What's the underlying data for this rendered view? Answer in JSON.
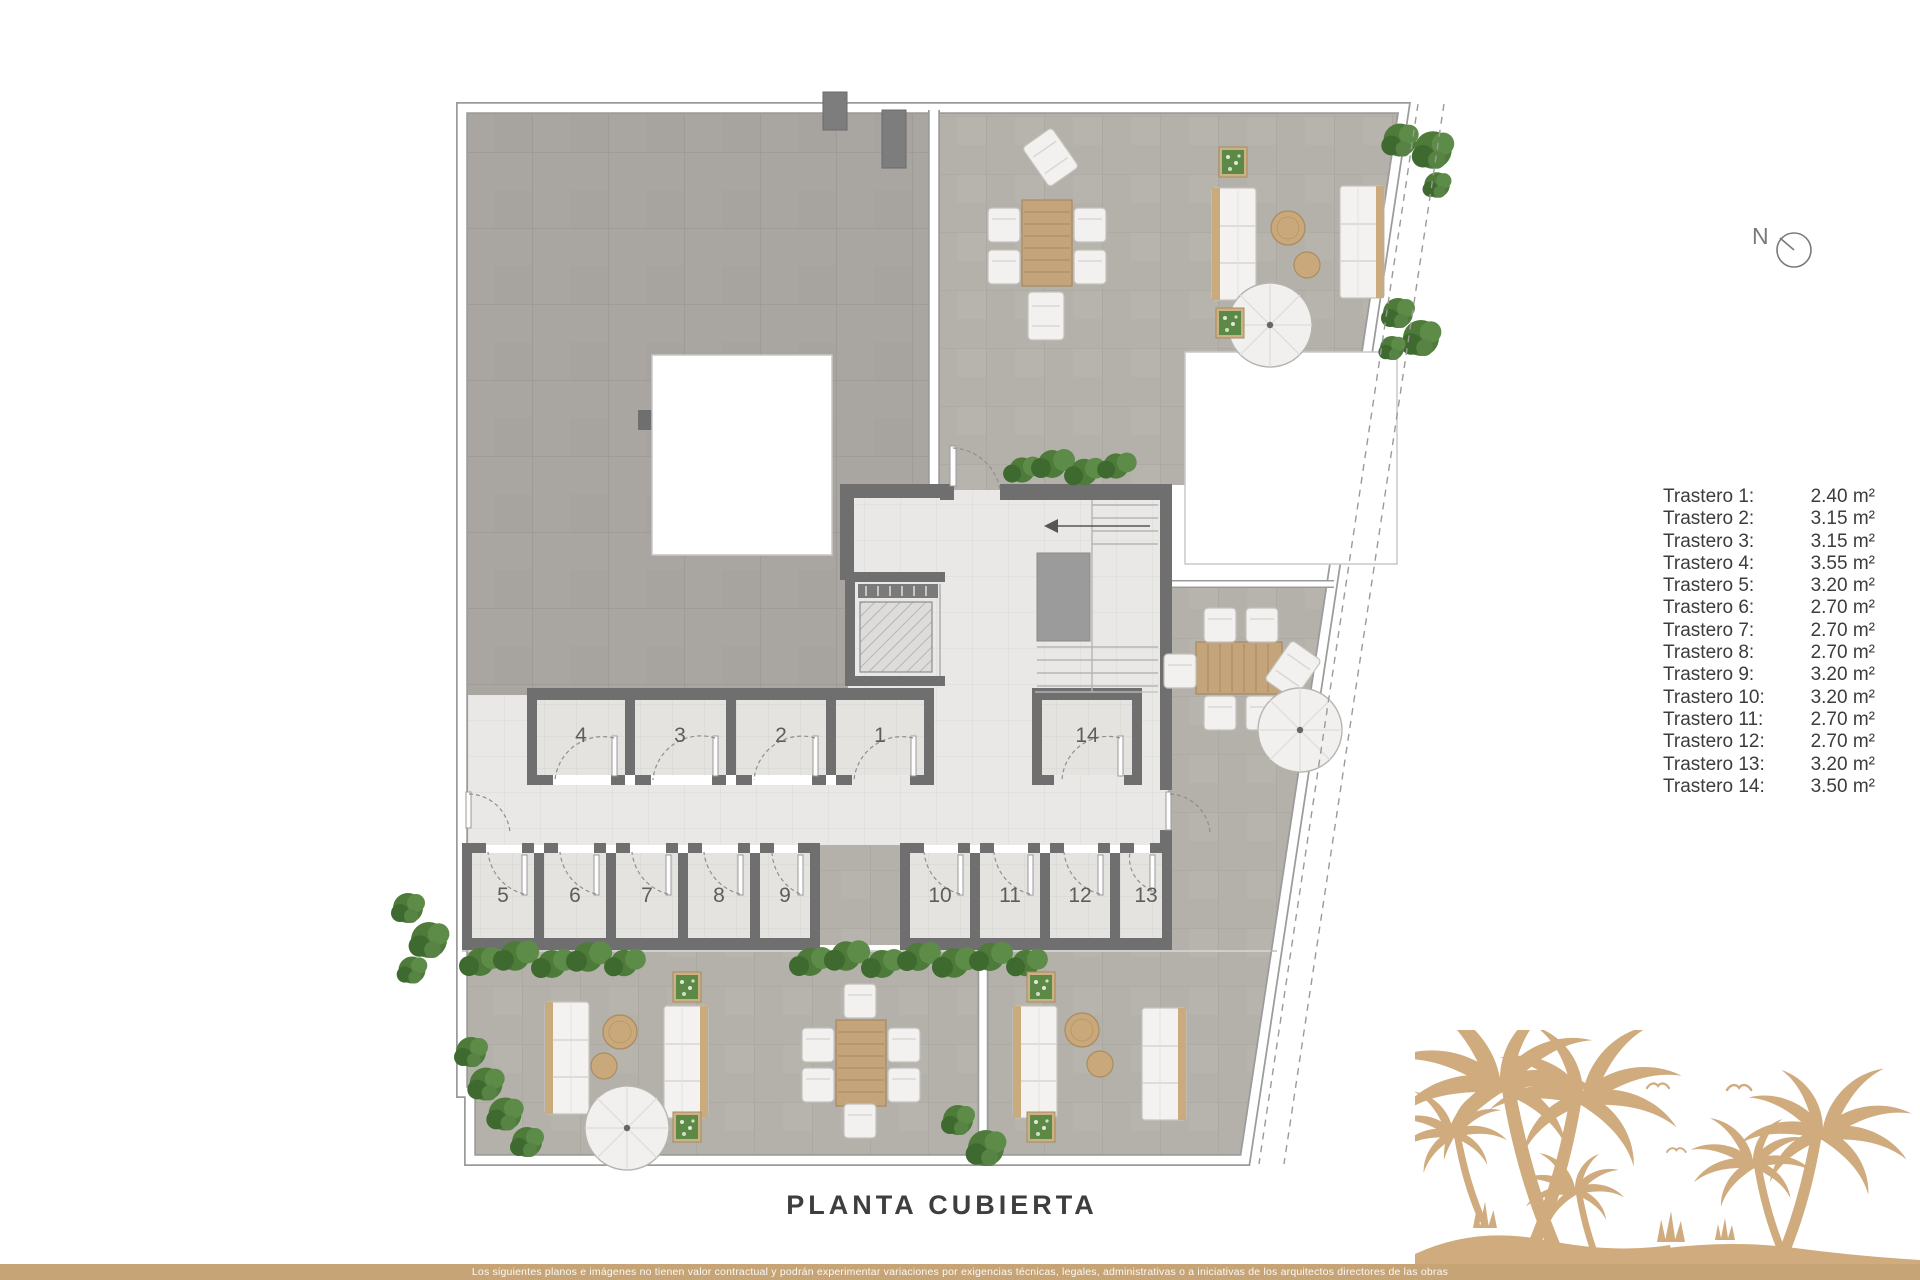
{
  "title": "PLANTA CUBIERTA",
  "compass": {
    "label": "N"
  },
  "legend": {
    "items": [
      {
        "label": "Trastero 1:",
        "value": "2.40 m²"
      },
      {
        "label": "Trastero 2:",
        "value": "3.15 m²"
      },
      {
        "label": "Trastero 3:",
        "value": "3.15 m²"
      },
      {
        "label": "Trastero 4:",
        "value": "3.55 m²"
      },
      {
        "label": "Trastero 5:",
        "value": "3.20 m²"
      },
      {
        "label": "Trastero 6:",
        "value": "2.70 m²"
      },
      {
        "label": "Trastero 7:",
        "value": "2.70 m²"
      },
      {
        "label": "Trastero 8:",
        "value": "2.70 m²"
      },
      {
        "label": "Trastero 9:",
        "value": "3.20 m²"
      },
      {
        "label": "Trastero 10:",
        "value": "3.20 m²"
      },
      {
        "label": "Trastero 11:",
        "value": "2.70 m²"
      },
      {
        "label": "Trastero 12:",
        "value": "2.70 m²"
      },
      {
        "label": "Trastero 13:",
        "value": "3.20 m²"
      },
      {
        "label": "Trastero 14:",
        "value": "3.50 m²"
      }
    ]
  },
  "plan": {
    "rooms": {
      "n1": "1",
      "n2": "2",
      "n3": "3",
      "n4": "4",
      "n5": "5",
      "n6": "6",
      "n7": "7",
      "n8": "8",
      "n9": "9",
      "n10": "10",
      "n11": "11",
      "n12": "12",
      "n13": "13",
      "n14": "14"
    }
  },
  "footer": {
    "disclaimer": "Los siguientes planos e imágenes no tienen valor contractual y podrán experimentar variaciones por exigencias técnicas, legales, administrativas o a iniciativas de los arquitectos directores de las obras"
  },
  "colors": {
    "accent_tan": "#c6a476",
    "palm_tan": "#cfab7d",
    "wall_gray": "#6f6f6f",
    "roof_tile": "#a9a6a1",
    "terrace_tile": "#b4b1ab",
    "hall_tile": "#e9e8e6",
    "plant_green": "#4e7a3a"
  }
}
